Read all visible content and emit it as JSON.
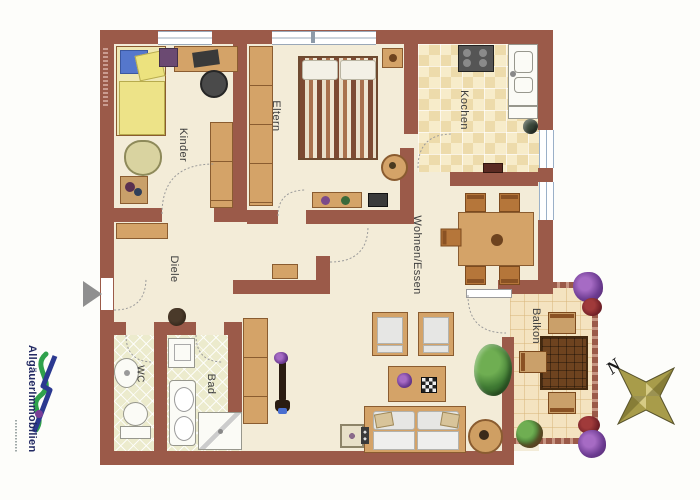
{
  "rooms": {
    "kinder": "Kinder",
    "eltern": "Eltern",
    "kochen": "Kochen",
    "wohnen_essen": "Wohnen/Essen",
    "diele": "Diele",
    "wc": "WC",
    "bad": "Bad",
    "balkon": "Balkon"
  },
  "compass": {
    "north": "N"
  },
  "branding": {
    "company": "AllgäuerImmobilien"
  },
  "colors": {
    "wall": "#9b5a49",
    "floor": "#f3ecd8",
    "kitchen_tile": "#f2e2b9",
    "bath_tile": "#ecebcd",
    "balcony_tile": "#f4e3c0",
    "wood": "#d4a368",
    "wood_dark": "#6e431f",
    "upholstery": "#e6e6e4",
    "logo_green": "#2fa14c",
    "logo_blue": "#2b3990",
    "star": "#9a8f3c"
  }
}
